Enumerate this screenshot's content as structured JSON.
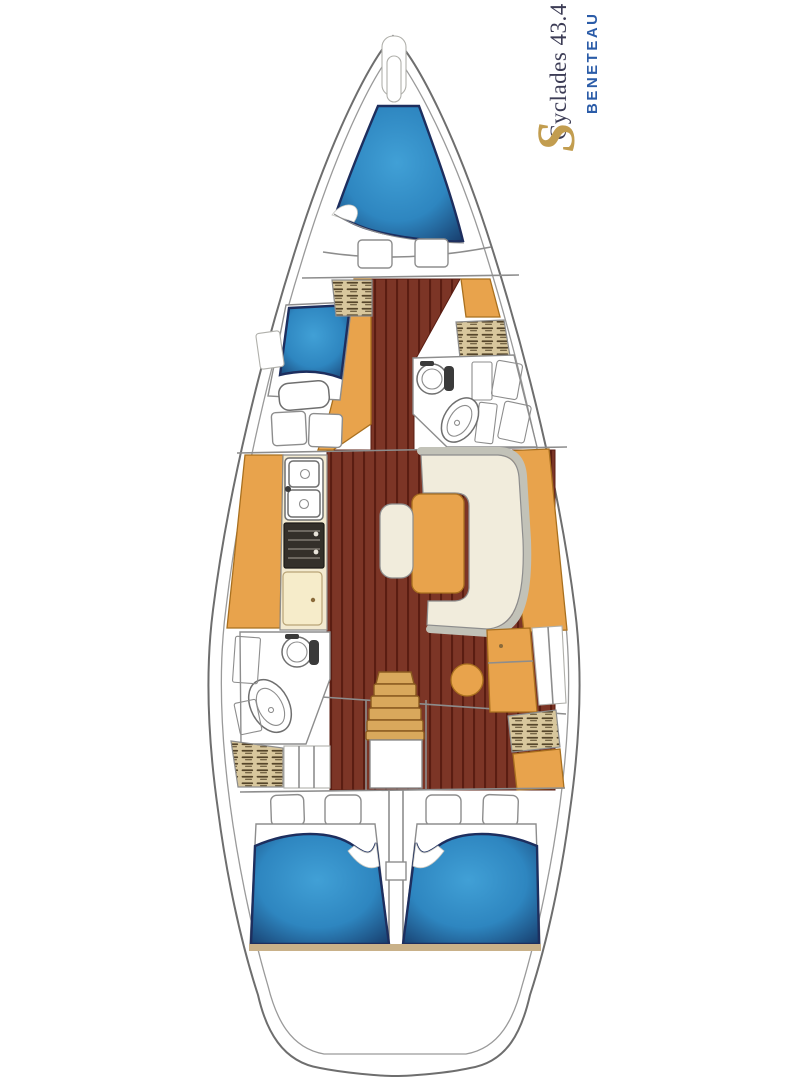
{
  "branding": {
    "model": "Cyclades 43.4",
    "brand": "BENETEAU"
  },
  "icons": {
    "beneteau_logo_glyph": "S"
  },
  "colors": {
    "hull_stroke": "#6e6e6e",
    "inner_stroke": "#9a9a9a",
    "line_gray": "#8d8d8d",
    "berth_blue": "#2e86c0",
    "berth_blue_light": "#41a0d6",
    "berth_blue_dark": "#173c6b",
    "berth_border": "#1d2e5e",
    "wood": "#7c3526",
    "wood_line": "#5a1d12",
    "furniture_orange": "#e8a34c",
    "orange_stroke": "#a9701f",
    "cream": "#f1ecdc",
    "counter_cream": "#f3ead0",
    "fridge_cream": "#f6ecca",
    "locker_tan": "#d8c79d",
    "locker_line": "#55452a",
    "stove_dark": "#34302a",
    "stove_line": "#8f8a80",
    "backrest_gray": "#c2c2b8",
    "stern_tan": "#c9b189",
    "brand_navy": "#3c3c55",
    "brand_blue": "#2b5ca8",
    "brand_gold": "#c29d4f"
  }
}
